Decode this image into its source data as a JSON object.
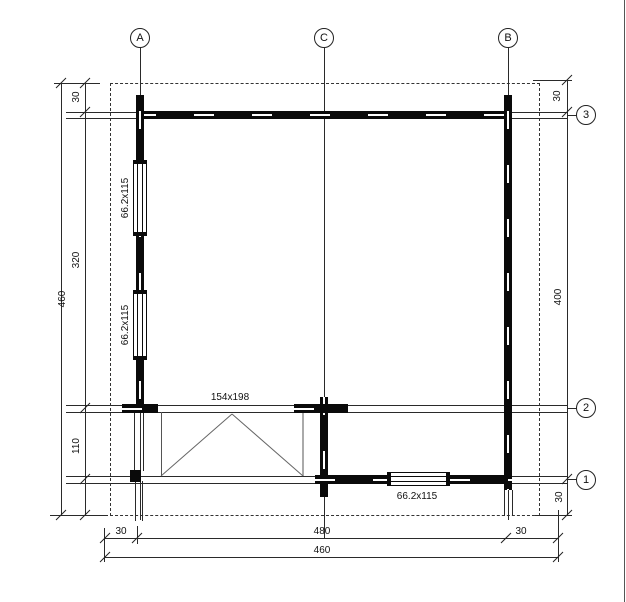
{
  "axes": {
    "top": [
      {
        "label": "A"
      },
      {
        "label": "C"
      },
      {
        "label": "B"
      }
    ],
    "right": [
      {
        "label": "3"
      },
      {
        "label": "2"
      },
      {
        "label": "1"
      }
    ]
  },
  "dimensions": {
    "left_overhang": "30",
    "left_upper": "320",
    "left_lower": "110",
    "left_total": "460",
    "right_overhang_top": "30",
    "right_main": "400",
    "right_overhang_bottom": "30",
    "bottom_left_overhang": "30",
    "bottom_main": "480",
    "bottom_right_overhang": "30",
    "bottom_total": "460"
  },
  "openings": {
    "window_left_upper": "66.2x115",
    "window_left_lower": "66.2x115",
    "window_bottom": "66.2x115",
    "door_front": "154x198"
  }
}
